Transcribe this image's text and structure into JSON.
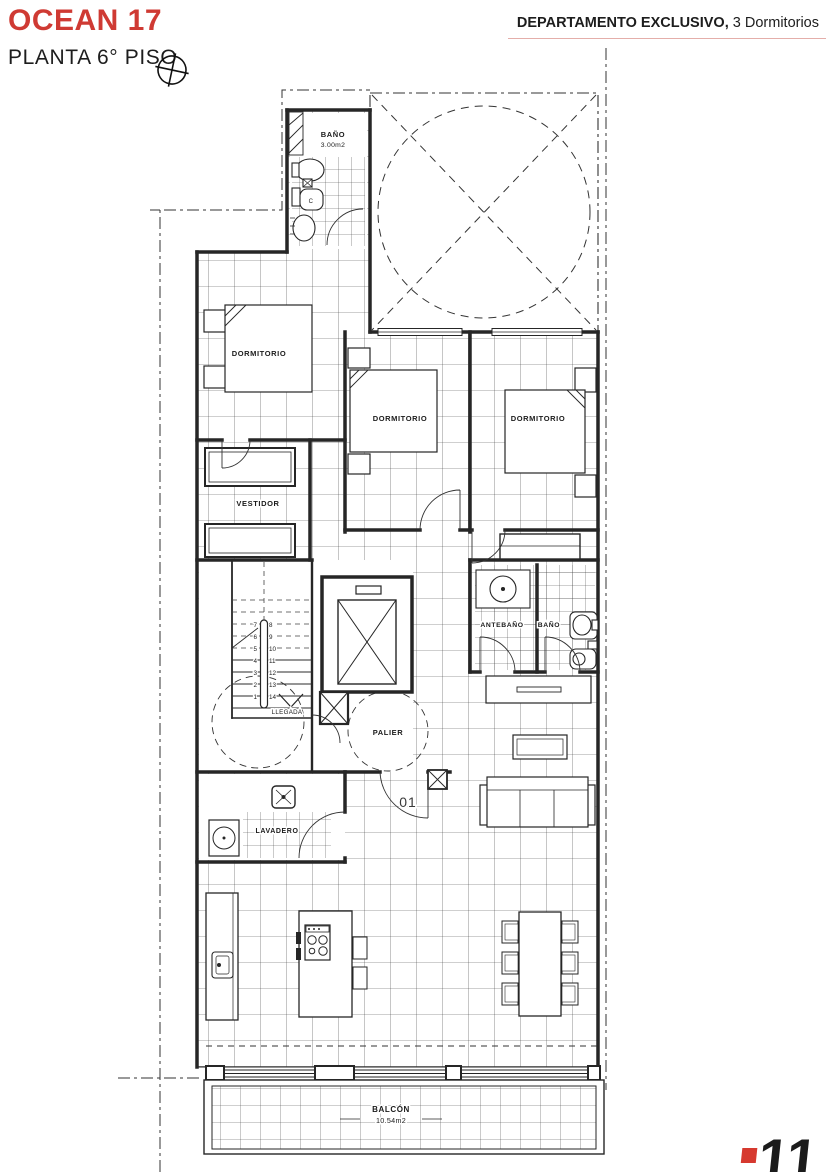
{
  "header": {
    "project": "OCEAN 17",
    "floor": "PLANTA 6° PISO",
    "unit_type": "DEPARTAMENTO EXCLUSIVO,",
    "unit_detail": " 3 Dormitorios",
    "accent_color": "#cf3a33"
  },
  "plan": {
    "rooms": {
      "bano_top": {
        "label": "BAÑO",
        "area": "3.00m2"
      },
      "dormitorio": "DORMITORIO",
      "vestidor": "VESTIDOR",
      "antebano": "ANTEBAÑO",
      "bano": "BAÑO",
      "palier": "PALIER",
      "lavadero": "LAVADERO",
      "balcon": {
        "label": "BALCÓN",
        "area": "10.54m2"
      }
    },
    "stairs": {
      "left_numbers": [
        "7",
        "6",
        "5",
        "4",
        "3",
        "2",
        "1"
      ],
      "right_numbers": [
        "8",
        "9",
        "10",
        "11",
        "12",
        "13",
        "14"
      ],
      "landing": "LLEGADA"
    },
    "unit_number": "01",
    "toilet_tag": "C"
  },
  "logo": {
    "digits": "11",
    "color": "#d6392f"
  }
}
